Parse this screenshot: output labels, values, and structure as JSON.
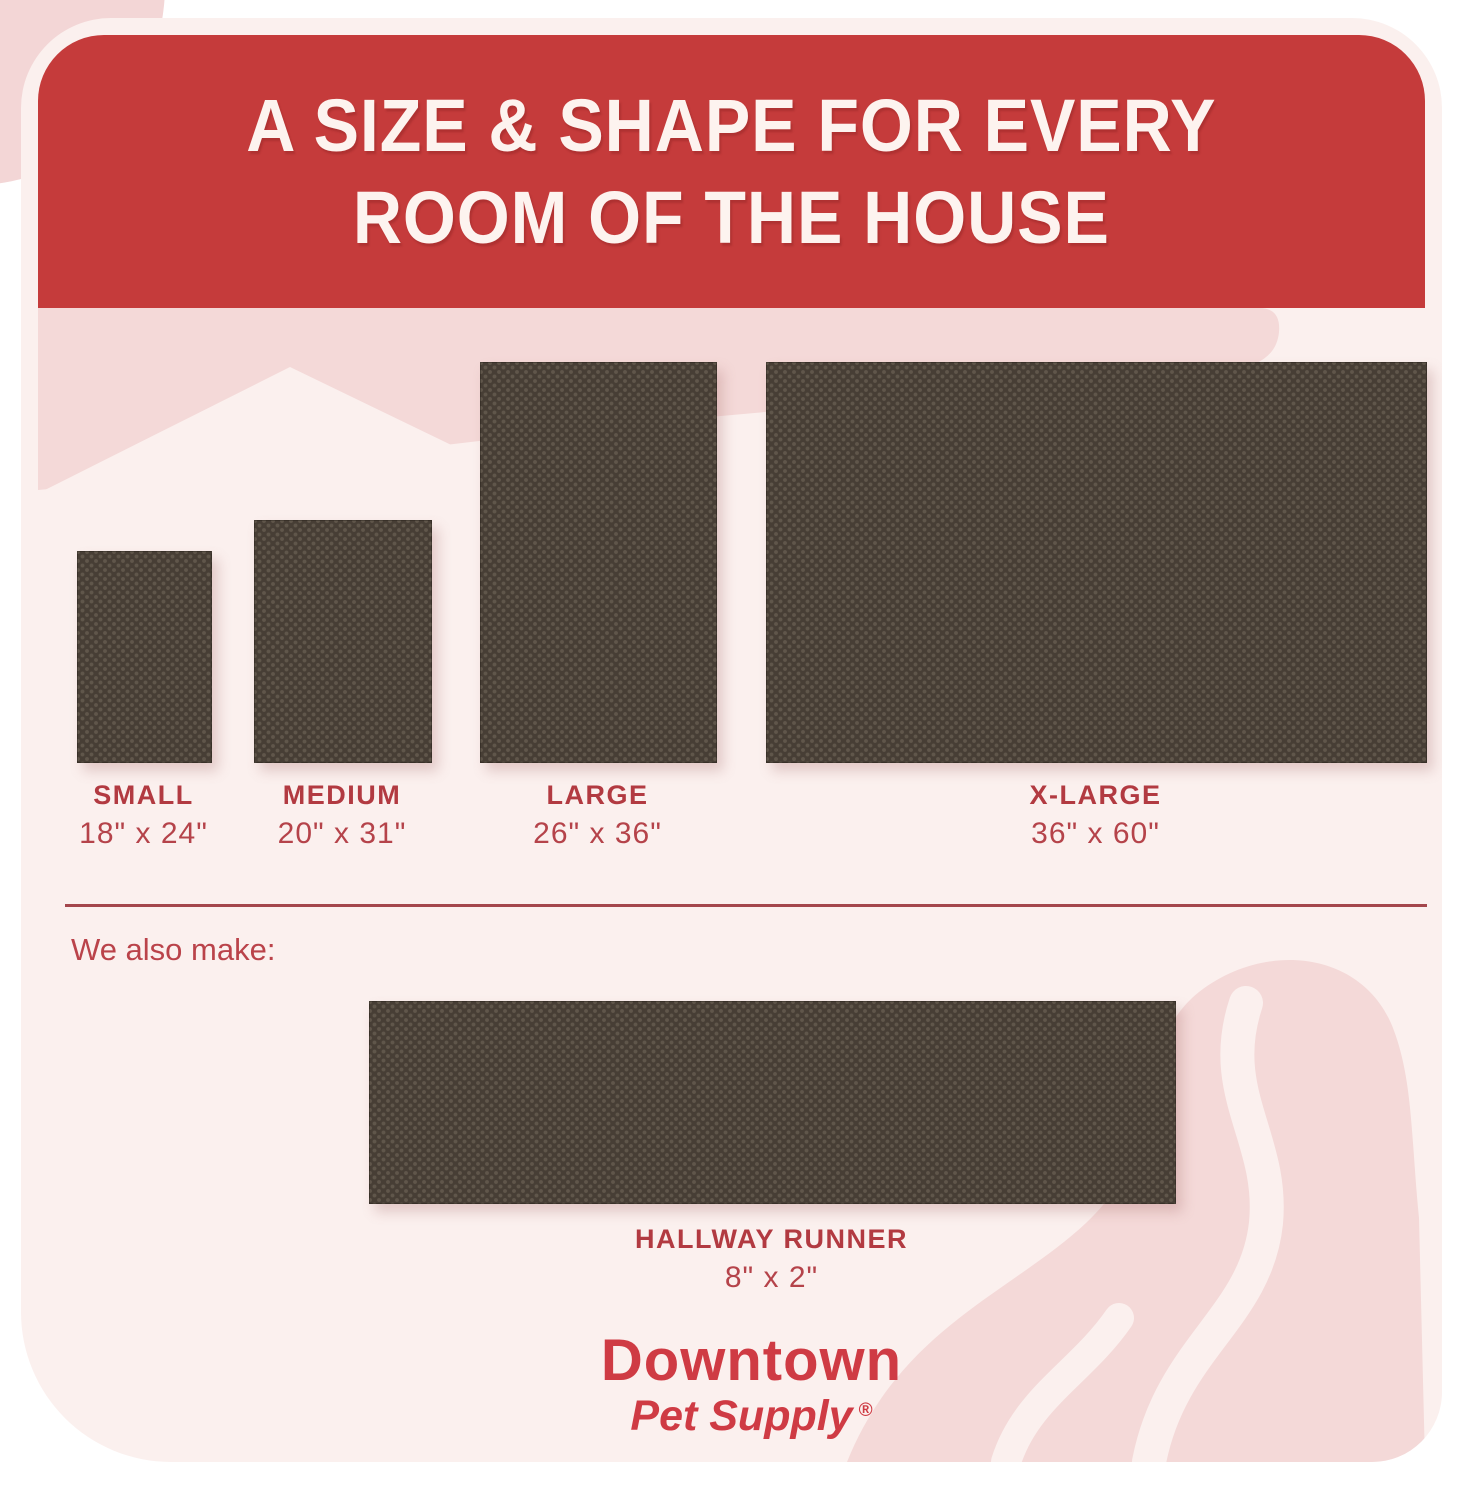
{
  "header": {
    "title_line1": "A SIZE & SHAPE FOR EVERY",
    "title_line2": "ROOM OF THE HOUSE"
  },
  "mats": [
    {
      "name": "SMALL",
      "size": "18\" x 24\""
    },
    {
      "name": "MEDIUM",
      "size": "20\" x 31\""
    },
    {
      "name": "LARGE",
      "size": "26\" x 36\""
    },
    {
      "name": "X-LARGE",
      "size": "36\" x 60\""
    }
  ],
  "also_make": {
    "label": "We also make:"
  },
  "runner": {
    "name": "HALLWAY RUNNER",
    "size": "8\" x 2\""
  },
  "logo": {
    "brand": "Downtown",
    "sub": "Pet Supply",
    "registered": "®"
  },
  "colors": {
    "banner_red": "#c53b3b",
    "label_red": "#b23a41",
    "logo_red": "#cf3b44",
    "card_pink": "#fbf0ee",
    "deco_pink": "#f4d9d8",
    "mat_brown": "#473e35"
  }
}
